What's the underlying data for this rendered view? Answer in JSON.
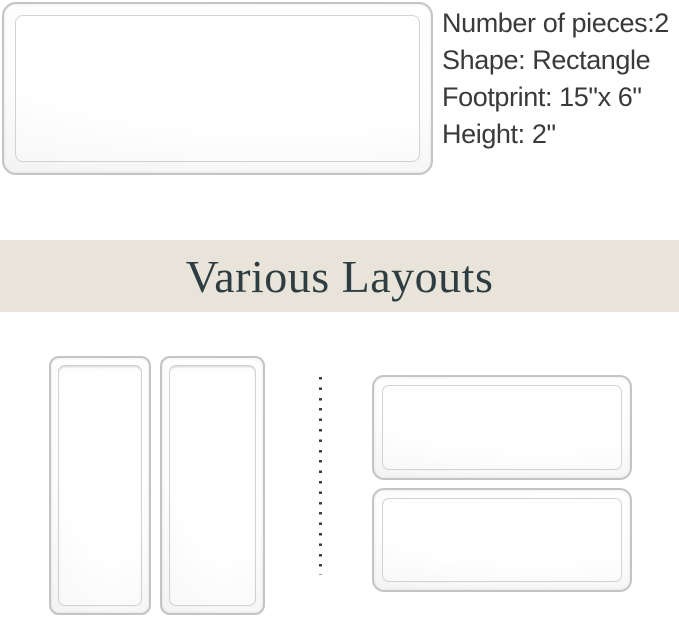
{
  "hero": {
    "specs": {
      "pieces": "Number of pieces:2",
      "shape": "Shape: Rectangle",
      "footprint": "Footprint: 15\"x 6\"",
      "height": "Height: 2\""
    }
  },
  "banner": {
    "title": "Various Layouts"
  },
  "theme": {
    "banner_bg": "#e8e4d9",
    "banner_text": "#2e3d41",
    "spec_text": "#3a3a3a",
    "tray_border": "#c4c4c4",
    "tray_border_inner": "#d2d2d2",
    "dot_color": "#3d3d3d"
  }
}
